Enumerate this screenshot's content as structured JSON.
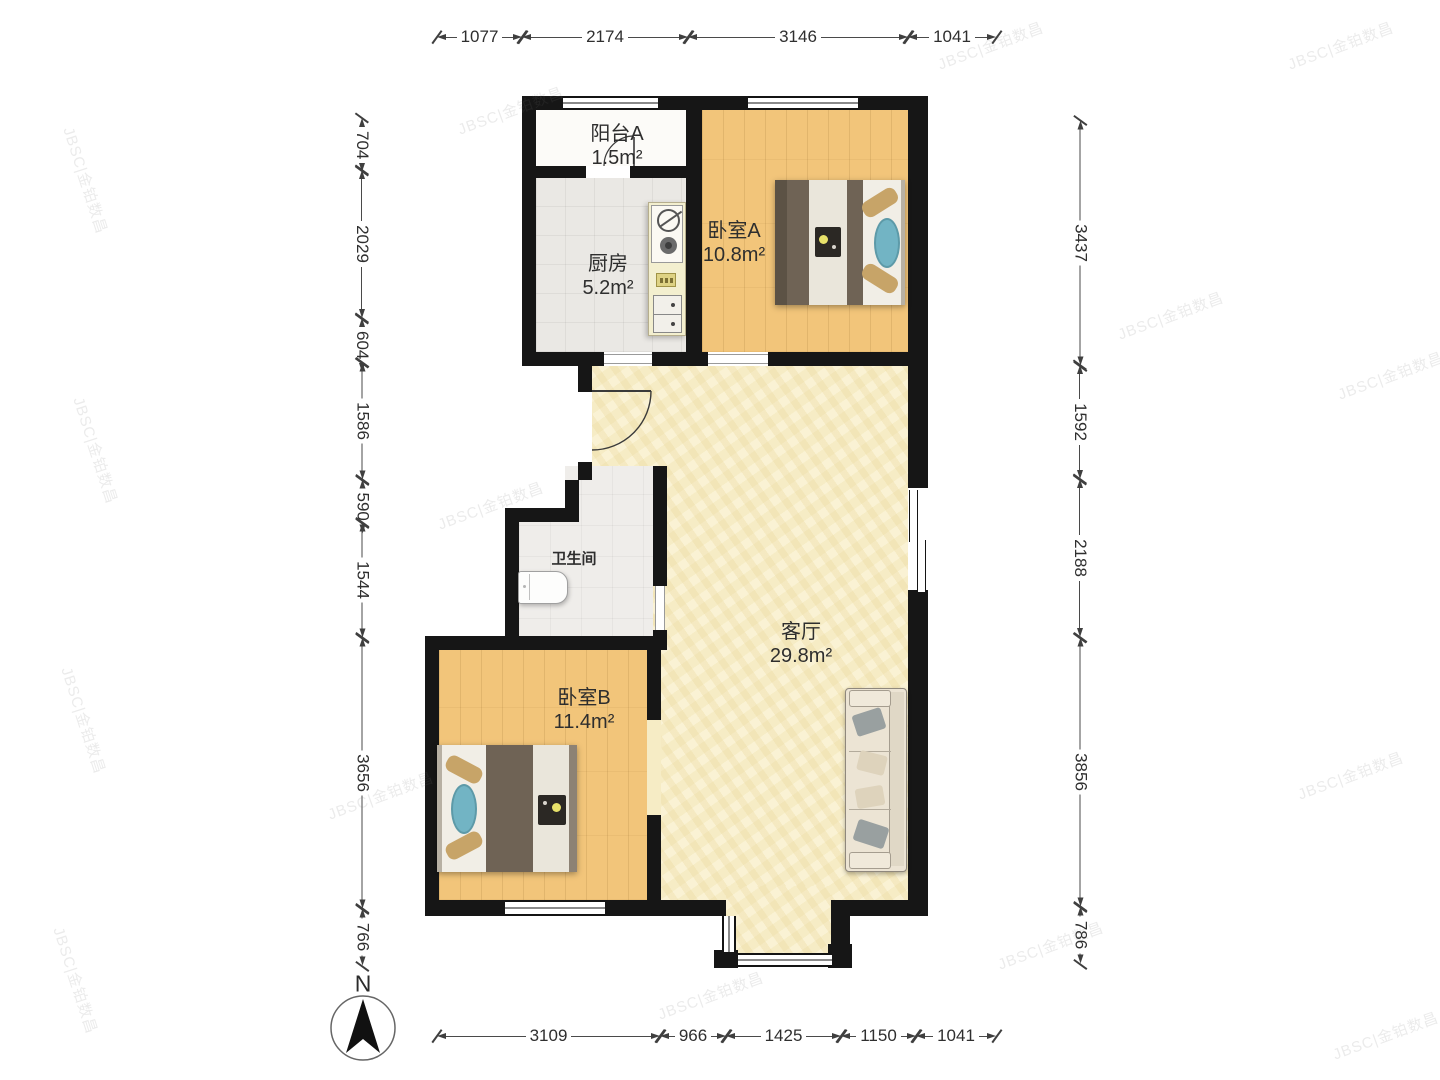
{
  "watermark": {
    "text": "JBSC|金铂数昌"
  },
  "compass": {
    "label": "N"
  },
  "rooms": [
    {
      "id": "balcony-a",
      "name": "阳台A",
      "area": "1.5m²"
    },
    {
      "id": "kitchen",
      "name": "厨房",
      "area": "5.2m²"
    },
    {
      "id": "bedroom-a",
      "name": "卧室A",
      "area": "10.8m²"
    },
    {
      "id": "bathroom",
      "name": "卫生间",
      "area": ""
    },
    {
      "id": "living-room",
      "name": "客厅",
      "area": "29.8m²"
    },
    {
      "id": "bedroom-b",
      "name": "卧室B",
      "area": "11.4m²"
    }
  ],
  "dimensions": {
    "top": [
      "1077",
      "2174",
      "3146",
      "1041"
    ],
    "bottom": [
      "3109",
      "966",
      "1425",
      "1150",
      "1041"
    ],
    "left": [
      "704",
      "2029",
      "604",
      "1586",
      "590",
      "1544",
      "3656",
      "766"
    ],
    "right": [
      "3437",
      "1592",
      "2188",
      "3856",
      "786"
    ]
  }
}
